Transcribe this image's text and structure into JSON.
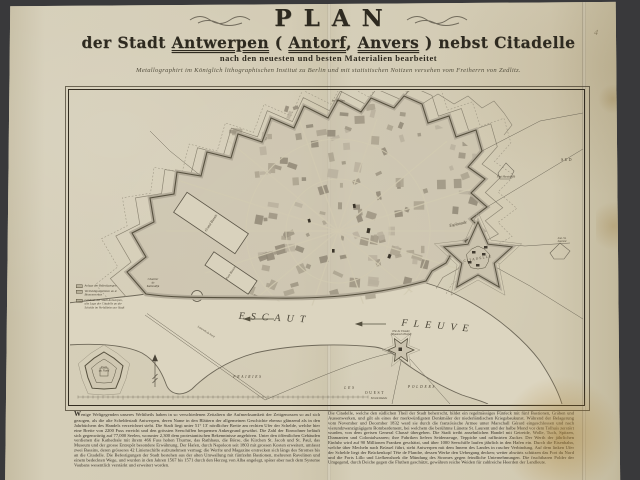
{
  "colors": {
    "background": "#39393b",
    "paper": "#d2cab2",
    "ink": "#2e2a20",
    "map_line": "#5a5446",
    "rampart_fill": "#b3ab99",
    "river": "#dcd5c0"
  },
  "title": {
    "main": "PLAN",
    "line2_parts": [
      {
        "t": "der Stadt ",
        "u": false
      },
      {
        "t": "Antwerpen",
        "u": true
      },
      {
        "t": " ( ",
        "u": false
      },
      {
        "t": "Antorf",
        "u": true
      },
      {
        "t": ", ",
        "u": false
      },
      {
        "t": "Anvers",
        "u": true
      },
      {
        "t": " ) nebst Citadelle",
        "u": false
      }
    ],
    "line3": "nach den neuesten und besten Materialien bearbeitet",
    "line4": "Metallographirt im Königlich lithographischen Institut zu Berlin und mit statistischen Notizen versehen vom Freiherrn von Zedlitz."
  },
  "marginalia": "4",
  "map": {
    "labels": [
      {
        "t": "ESCAUT",
        "x": 205,
        "y": 227,
        "s": 10,
        "r": 3,
        "sp": 6,
        "i": 1,
        "c": "#4a4538"
      },
      {
        "t": "FLEUVE",
        "x": 368,
        "y": 235,
        "s": 10,
        "r": 5,
        "sp": 6,
        "i": 1,
        "c": "#4a4538"
      },
      {
        "t": "CITADELLE",
        "x": 408,
        "y": 168,
        "s": 3.4,
        "r": -10,
        "sp": 1.2
      },
      {
        "t": "Esplanade",
        "x": 388,
        "y": 133,
        "s": 4.2,
        "r": -12,
        "i": 1
      },
      {
        "t": "Grand Bassin",
        "x": 141,
        "y": 132,
        "s": 3.6,
        "r": -56,
        "i": 1
      },
      {
        "t": "Petit Bassin",
        "x": 161,
        "y": 182,
        "s": 3.2,
        "r": -56,
        "i": 1
      },
      {
        "t": "Chantier\nde\nKattendijk",
        "x": 83,
        "y": 192,
        "s": 3,
        "r": 0,
        "i": 1
      },
      {
        "t": "Fort\ndu Nord",
        "x": 34,
        "y": 278,
        "s": 3.2,
        "r": 0,
        "i": 1
      },
      {
        "t": "Tête de Flandre\n(Vlaamsch Hoofd)",
        "x": 331,
        "y": 242,
        "s": 2.8,
        "r": 0,
        "i": 1
      },
      {
        "t": "PRAIRIES",
        "x": 178,
        "y": 286,
        "s": 3.6,
        "sp": 1.8,
        "i": 1
      },
      {
        "t": "LES",
        "x": 280,
        "y": 297,
        "s": 3.6,
        "sp": 1.8,
        "i": 1
      },
      {
        "t": "POLDERS",
        "x": 352,
        "y": 296,
        "s": 3.6,
        "sp": 1.8,
        "i": 1
      },
      {
        "t": "OUEST",
        "x": 305,
        "y": 302,
        "s": 3.8,
        "sp": 1.6
      },
      {
        "t": "Echelle Réduite",
        "x": 309,
        "y": 308,
        "s": 2.6,
        "i": 1
      },
      {
        "t": "SUD",
        "x": 497,
        "y": 69,
        "s": 3.8,
        "sp": 1.4
      },
      {
        "t": "1er Bastion",
        "x": 268,
        "y": 10,
        "s": 2.8,
        "i": 1
      },
      {
        "t": "Fort Montebello",
        "x": 436,
        "y": 86,
        "s": 2.8,
        "i": 1
      },
      {
        "t": "Lun. St. Laurent",
        "x": 492,
        "y": 149,
        "s": 2.8,
        "i": 1
      },
      {
        "t": "Lazareth du Nord",
        "x": 136,
        "y": 241,
        "s": 2.8,
        "r": 33,
        "i": 1
      }
    ],
    "legend": {
      "items": [
        {
          "label": "Anlage der Befestigungen"
        },
        {
          "label": "Vertheidigungslinien an d.\nBinnenwerken"
        },
        {
          "label": "Gebäude der Stadt Antwerpen,\nalte Lage der Citadelle an der\nSchelde im Verhältniss zur Stadt"
        }
      ]
    }
  },
  "notes": {
    "col1": "Wenige Weltgegenden unseres Welttheils haben in so verschiedenen Zeitaltern die Aufmerksamkeit der Zeitgenossen so auf sich gezogen, als die alte Scheldestadt Antwerpen, deren Name in den Blättern der allgemeinen Geschichte ebenso glänzend als in den Jahrbüchern des Handels verzeichnet steht. Die Stadt liegt unter 51° 13' nördlicher Breite am rechten Ufer der Schelde, welche hier eine Breite von 2200 Fuss erreicht und den grössten Seeschiffen bequemen Ankergrund gewährt. Die Zahl der Einwohner beläuft sich gegenwärtig auf 77,000 Seelen, worunter 2,300 dem protestantischen Bekenntnisse angehören. Unter den öffentlichen Gebäuden verdienen die Kathedrale mit ihrem 466 Fuss hohen Thurme, das Rathhaus, die Börse, die Kirchen St. Jacob und St. Paul, das Museum und der grosse Entrepôt besondere Erwähnung. Der Hafen, durch Napoleon seit 1803 mit grossen Kosten erweitert, umfasst zwei Bassins, deren grösseres 42 Linienschiffe aufzunehmen vermag; die Werfte und Magazine erstrecken sich längs des Stromes bis an die Citadelle. Die Befestigungen der Stadt bestehen aus der alten Umwallung mit fünfzehn Bastionen, mehreren Ravelinen und einem bedeckten Wege, und wurden in den Jahren 1567 bis 1571 durch den Herzog von Alba angelegt, später aber nach dem Systeme Vaubans wesentlich verstärkt und erweitert worden.",
    "col2": "Die Citadelle, welche den südlichen Theil der Stadt beherrscht, bildet ein regelmässiges Fünfeck mit fünf Bastionen, Gräben und Aussenwerken, und gilt als eines der merkwürdigsten Denkmäler der niederländischen Kriegsbaukunst. Während der Belagerung vom November und December 1832 ward sie durch die französische Armee unter Marschall Gérard eingeschlossen und nach vierundzwanzigtägigem Bombardement, bei welchem die berühmte Lünette St. Laurent und der halbe Mond vor dem Tolhuis zerstört wurden, von dem greisen General Chassé übergeben. Die Stadt treibt ansehnlichen Handel mit Getreide, Wolle, Tuch, Spitzen, Diamanten und Colonialwaaren; ihre Fabriken liefern Seidenzeuge, Teppiche und raffinirten Zucker. Der Werth der jährlichen Einfuhr wird auf 90 Millionen Franken geschätzt, und über 1000 Seeschiffe laufen jährlich in den Hafen ein. Durch die Eisenbahn, welche über Mecheln nach Brüssel führt, steht Antwerpen mit dem Innern des Landes in rascher Verbindung. Auf dem linken Ufer der Schelde liegt der Brückenkopf Tête de Flandre, dessen Werke den Uebergang decken; weiter abwärts schützen das Fort du Nord und die Forts Lillo und Liefkenshoek die Mündung des Stromes gegen feindliche Unternehmungen. Die fruchtbaren Polder der Umgegend, durch Deiche gegen die Fluthen geschützt, gewähren reiche Weiden für zahlreiche Heerden der Landleute."
  }
}
